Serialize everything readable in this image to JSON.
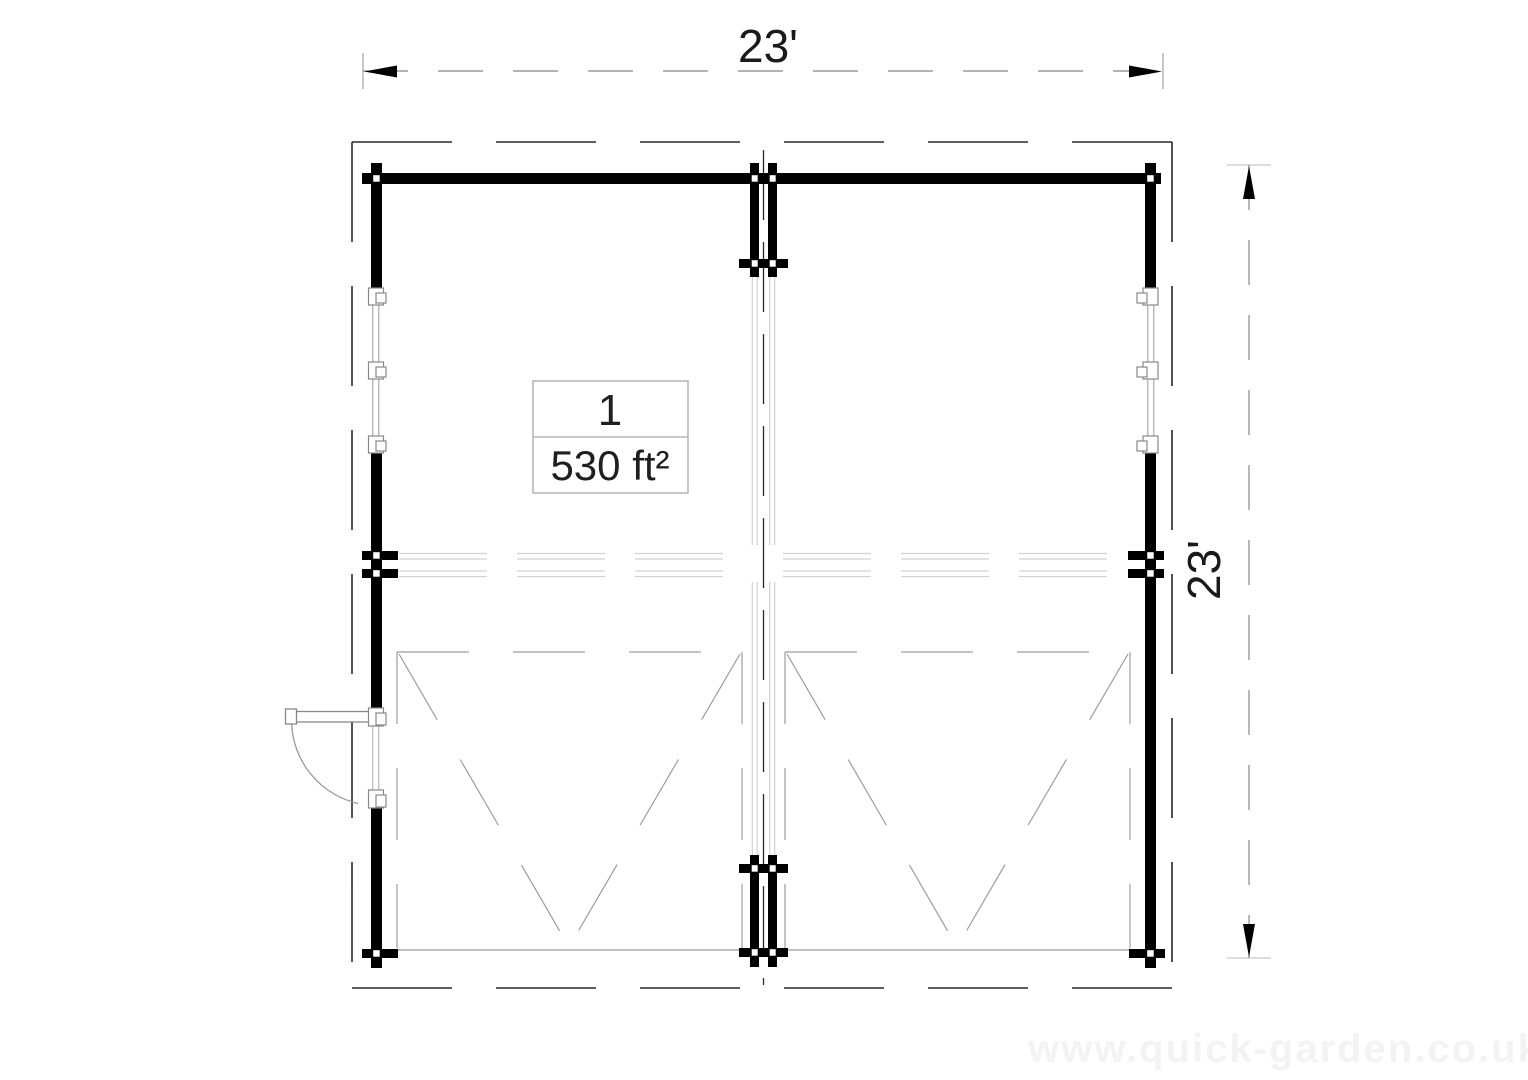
{
  "plan": {
    "room": {
      "number": "1",
      "area": "530 ft²"
    },
    "dimensions": {
      "width_label": "23'",
      "height_label": "23'"
    },
    "watermark": "www.quick-garden.co.uk",
    "colors": {
      "wall": "#000000",
      "boundary": "#2a2a2a",
      "dimension_line": "#888888",
      "detail_line": "#999999",
      "light_line": "#d2d2d2",
      "text": "#1a1a1a"
    }
  }
}
